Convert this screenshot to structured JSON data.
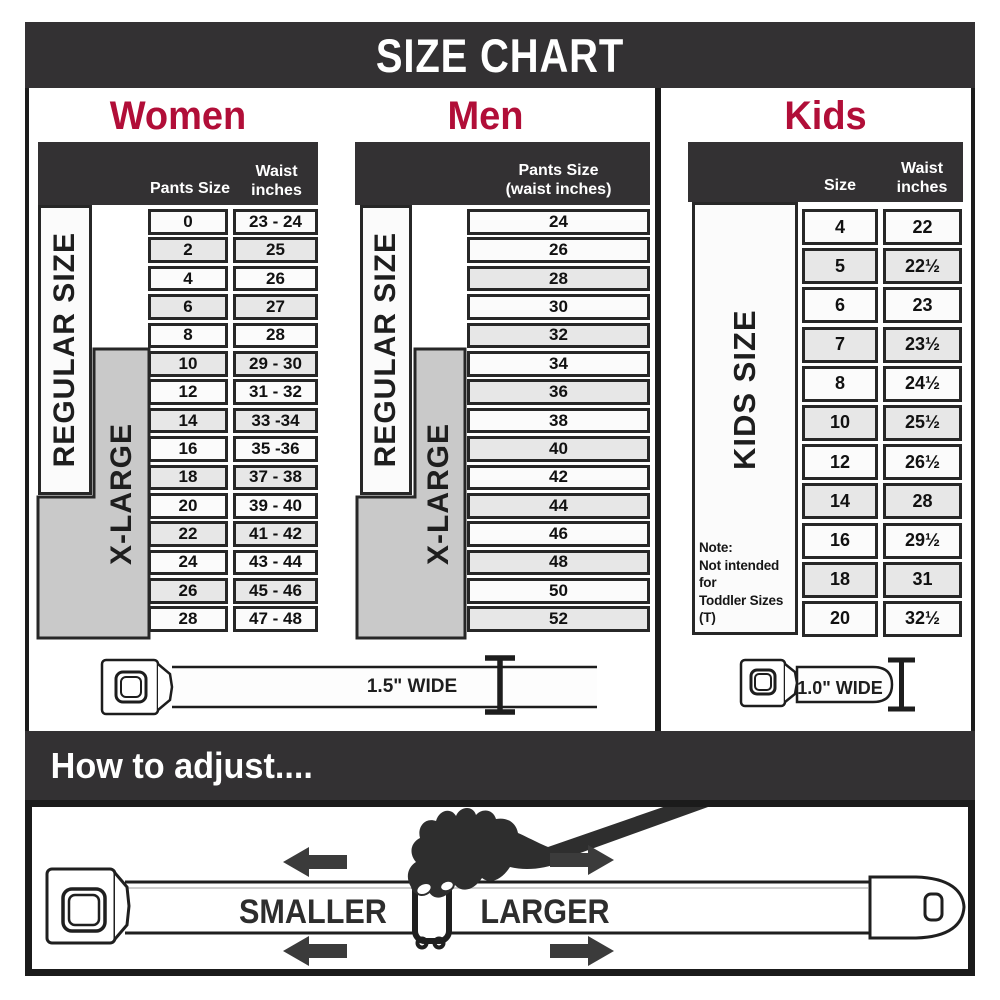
{
  "title": "SIZE CHART",
  "colors": {
    "header_bg": "#333133",
    "accent_red": "#b10e38",
    "row_light": "#fbfbfb",
    "row_alt": "#e7e7e7",
    "xlarge_gray": "#c9c9c9",
    "line": "#272727"
  },
  "sections": {
    "women": {
      "label": "Women",
      "header_col1": "Pants Size",
      "header_col2": "Waist\ninches",
      "regular_label": "REGULAR SIZE",
      "xlarge_label": "X-LARGE"
    },
    "men": {
      "label": "Men",
      "header_col1": "Pants Size\n(waist inches)",
      "regular_label": "REGULAR SIZE",
      "xlarge_label": "X-LARGE"
    },
    "kids": {
      "label": "Kids",
      "header_col1": "Size",
      "header_col2": "Waist\ninches",
      "side_label": "KIDS SIZE",
      "note_line1": "Note:",
      "note_line2": "Not intended for",
      "note_line3": "Toddler Sizes (T)"
    }
  },
  "tables": {
    "women": {
      "rows": [
        [
          "0",
          "23 - 24"
        ],
        [
          "2",
          "25"
        ],
        [
          "4",
          "26"
        ],
        [
          "6",
          "27"
        ],
        [
          "8",
          "28"
        ],
        [
          "10",
          "29 - 30"
        ],
        [
          "12",
          "31 - 32"
        ],
        [
          "14",
          "33 -34"
        ],
        [
          "16",
          "35 -36"
        ],
        [
          "18",
          "37 - 38"
        ],
        [
          "20",
          "39 - 40"
        ],
        [
          "22",
          "41 - 42"
        ],
        [
          "24",
          "43 - 44"
        ],
        [
          "26",
          "45 - 46"
        ],
        [
          "28",
          "47 - 48"
        ]
      ]
    },
    "men": {
      "rows": [
        [
          "24"
        ],
        [
          "26"
        ],
        [
          "28"
        ],
        [
          "30"
        ],
        [
          "32"
        ],
        [
          "34"
        ],
        [
          "36"
        ],
        [
          "38"
        ],
        [
          "40"
        ],
        [
          "42"
        ],
        [
          "44"
        ],
        [
          "46"
        ],
        [
          "48"
        ],
        [
          "50"
        ],
        [
          "52"
        ]
      ]
    },
    "kids": {
      "rows": [
        [
          "4",
          "22"
        ],
        [
          "5",
          "22½"
        ],
        [
          "6",
          "23"
        ],
        [
          "7",
          "23½"
        ],
        [
          "8",
          "24½"
        ],
        [
          "10",
          "25½"
        ],
        [
          "12",
          "26½"
        ],
        [
          "14",
          "28"
        ],
        [
          "16",
          "29½"
        ],
        [
          "18",
          "31"
        ],
        [
          "20",
          "32½"
        ]
      ]
    }
  },
  "belts": {
    "adult_width_label": "1.5\" WIDE",
    "kids_width_label": "1.0\" WIDE"
  },
  "adjust": {
    "heading": "How to adjust....",
    "smaller_label": "SMALLER",
    "larger_label": "LARGER"
  },
  "chart_data": [
    {
      "type": "table",
      "title": "Women",
      "columns": [
        "Pants Size",
        "Waist inches"
      ],
      "rows": [
        [
          "0",
          "23 - 24"
        ],
        [
          "2",
          "25"
        ],
        [
          "4",
          "26"
        ],
        [
          "6",
          "27"
        ],
        [
          "8",
          "28"
        ],
        [
          "10",
          "29 - 30"
        ],
        [
          "12",
          "31 - 32"
        ],
        [
          "14",
          "33 -34"
        ],
        [
          "16",
          "35 -36"
        ],
        [
          "18",
          "37 - 38"
        ],
        [
          "20",
          "39 - 40"
        ],
        [
          "22",
          "41 - 42"
        ],
        [
          "24",
          "43 - 44"
        ],
        [
          "26",
          "45 - 46"
        ],
        [
          "28",
          "47 - 48"
        ]
      ],
      "row_groups": [
        {
          "label": "REGULAR SIZE",
          "from": "0",
          "to": "18"
        },
        {
          "label": "X-LARGE",
          "from": "10",
          "to": "28"
        }
      ],
      "belt_width": "1.5\" WIDE"
    },
    {
      "type": "table",
      "title": "Men",
      "columns": [
        "Pants Size (waist inches)"
      ],
      "rows": [
        [
          "24"
        ],
        [
          "26"
        ],
        [
          "28"
        ],
        [
          "30"
        ],
        [
          "32"
        ],
        [
          "34"
        ],
        [
          "36"
        ],
        [
          "38"
        ],
        [
          "40"
        ],
        [
          "42"
        ],
        [
          "44"
        ],
        [
          "46"
        ],
        [
          "48"
        ],
        [
          "50"
        ],
        [
          "52"
        ]
      ],
      "row_groups": [
        {
          "label": "REGULAR SIZE",
          "from": "24",
          "to": "42"
        },
        {
          "label": "X-LARGE",
          "from": "34",
          "to": "52"
        }
      ],
      "belt_width": "1.5\" WIDE"
    },
    {
      "type": "table",
      "title": "Kids",
      "columns": [
        "Size",
        "Waist inches"
      ],
      "rows": [
        [
          "4",
          "22"
        ],
        [
          "5",
          "22½"
        ],
        [
          "6",
          "23"
        ],
        [
          "7",
          "23½"
        ],
        [
          "8",
          "24½"
        ],
        [
          "10",
          "25½"
        ],
        [
          "12",
          "26½"
        ],
        [
          "14",
          "28"
        ],
        [
          "16",
          "29½"
        ],
        [
          "18",
          "31"
        ],
        [
          "20",
          "32½"
        ]
      ],
      "row_groups": [
        {
          "label": "KIDS SIZE",
          "from": "4",
          "to": "20"
        }
      ],
      "note": "Note: Not intended for Toddler Sizes (T)",
      "belt_width": "1.0\" WIDE"
    }
  ]
}
